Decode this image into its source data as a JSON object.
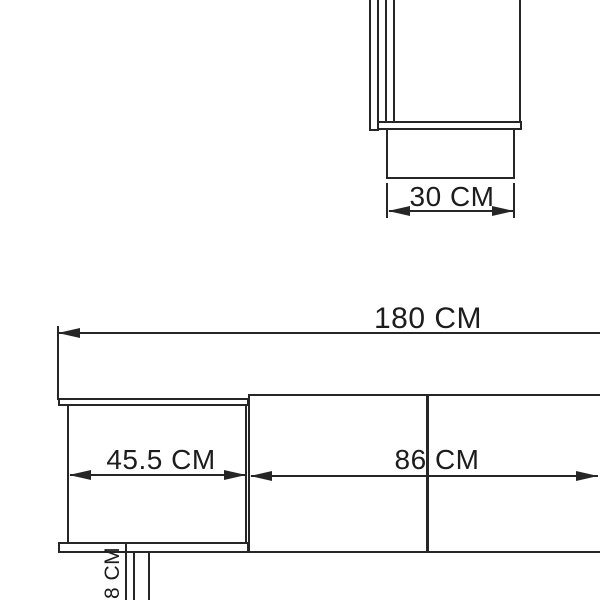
{
  "side_view": {
    "plinth_width_label": "30 CM"
  },
  "front_view": {
    "total_width_label": "180 CM",
    "left_section_width_label": "45.5 CM",
    "right_section_width_label": "86 CM",
    "leg_height_label": "18 CM"
  },
  "colors": {
    "line": "#262626",
    "text": "#1c1c1c",
    "background": "#ffffff"
  }
}
